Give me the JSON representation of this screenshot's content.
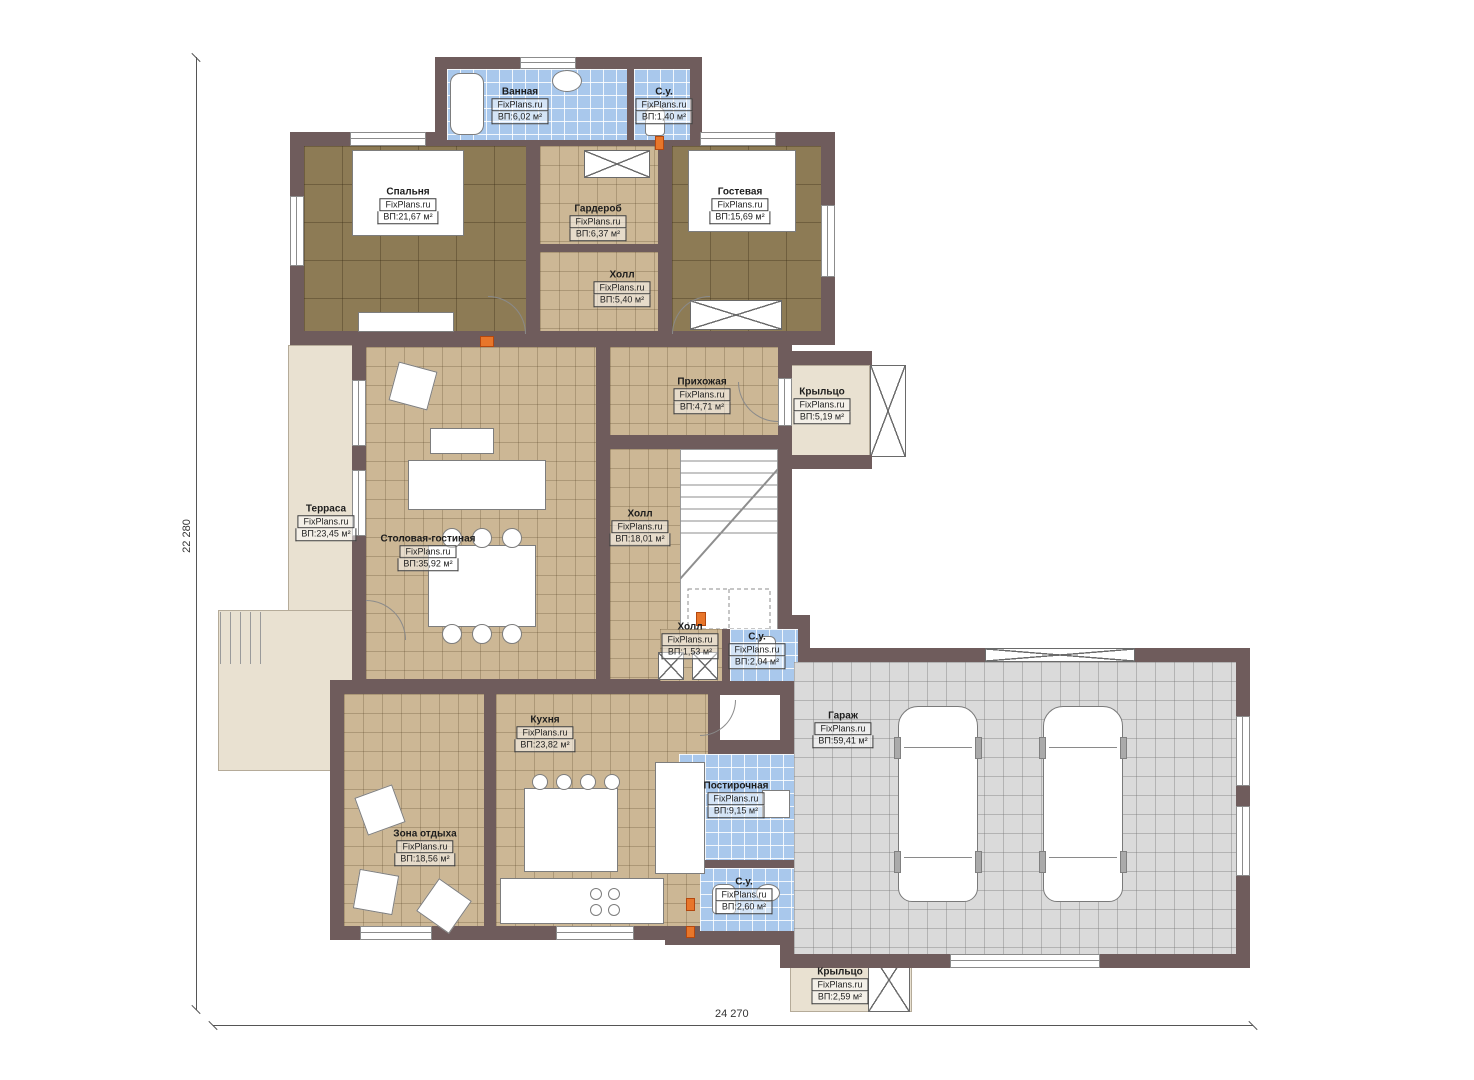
{
  "watermark": "FixPlans.ru",
  "dimensions": {
    "height_label": "22 280",
    "width_label": "24 270"
  },
  "colors": {
    "wall": "#6f5c5c",
    "floor_wood": "#8d7b55",
    "floor_tile": "#ccb795",
    "floor_wet": "#a9c8ec",
    "floor_garage": "#dadada",
    "floor_terrace": "#e9e1d1",
    "door_marker": "#e8762a"
  },
  "rooms": [
    {
      "name": "Ванная",
      "watermark": "FixPlans.ru",
      "area": "ВП:6,02 м²"
    },
    {
      "name": "С.у.",
      "watermark": "FixPlans.ru",
      "area": "ВП:1,40 м²"
    },
    {
      "name": "Спальня",
      "watermark": "FixPlans.ru",
      "area": "ВП:21,67 м²"
    },
    {
      "name": "Гардероб",
      "watermark": "FixPlans.ru",
      "area": "ВП:6,37 м²"
    },
    {
      "name": "Гостевая",
      "watermark": "FixPlans.ru",
      "area": "ВП:15,69 м²"
    },
    {
      "name": "Холл",
      "watermark": "FixPlans.ru",
      "area": "ВП:5,40 м²"
    },
    {
      "name": "Прихожая",
      "watermark": "FixPlans.ru",
      "area": "ВП:4,71 м²"
    },
    {
      "name": "Крыльцо",
      "watermark": "FixPlans.ru",
      "area": "ВП:5,19 м²"
    },
    {
      "name": "Терраса",
      "watermark": "FixPlans.ru",
      "area": "ВП:23,45 м²"
    },
    {
      "name": "Столовая-гостиная",
      "watermark": "FixPlans.ru",
      "area": "ВП:35,92 м²"
    },
    {
      "name": "Холл",
      "watermark": "FixPlans.ru",
      "area": "ВП:18,01 м²"
    },
    {
      "name": "Холл",
      "watermark": "FixPlans.ru",
      "area": "ВП:1,53 м²"
    },
    {
      "name": "С.у.",
      "watermark": "FixPlans.ru",
      "area": "ВП:2,04 м²"
    },
    {
      "name": "Кухня",
      "watermark": "FixPlans.ru",
      "area": "ВП:23,82 м²"
    },
    {
      "name": "Гараж",
      "watermark": "FixPlans.ru",
      "area": "ВП:59,41 м²"
    },
    {
      "name": "Постирочная",
      "watermark": "FixPlans.ru",
      "area": "ВП:9,15 м²"
    },
    {
      "name": "Зона отдыха",
      "watermark": "FixPlans.ru",
      "area": "ВП:18,56 м²"
    },
    {
      "name": "С.у.",
      "watermark": "FixPlans.ru",
      "area": "ВП:2,60 м²"
    },
    {
      "name": "Крыльцо",
      "watermark": "FixPlans.ru",
      "area": "ВП:2,59 м²"
    }
  ]
}
